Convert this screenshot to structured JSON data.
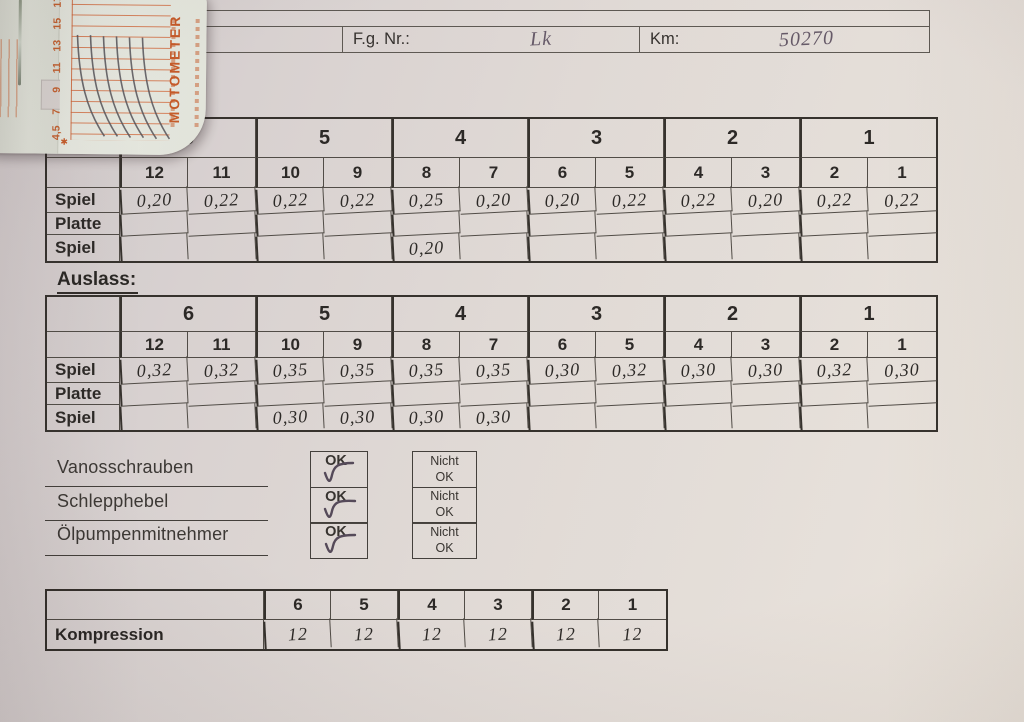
{
  "header": {
    "fg_label": "F.g. Nr.:",
    "fg_value": "Lk",
    "km_label": "Km:",
    "km_value": "50270"
  },
  "tool_card": {
    "brand": "MOTOMETER",
    "scale_labels": [
      "17",
      "15",
      "13",
      "11",
      "9",
      "7",
      "4,5"
    ]
  },
  "valve_tables": [
    {
      "title": "",
      "groups": [
        "6",
        "5",
        "4",
        "3",
        "2",
        "1"
      ],
      "valves": [
        "12",
        "11",
        "10",
        "9",
        "8",
        "7",
        "6",
        "5",
        "4",
        "3",
        "2",
        "1"
      ],
      "rows": [
        {
          "label": "Spiel",
          "values": [
            "0,20",
            "0,22",
            "0,22",
            "0,22",
            "0,25",
            "0,20",
            "0,20",
            "0,22",
            "0,22",
            "0,20",
            "0,22",
            "0,22"
          ]
        },
        {
          "label": "Platte",
          "values": [
            "",
            "",
            "",
            "",
            "",
            "",
            "",
            "",
            "",
            "",
            "",
            ""
          ]
        },
        {
          "label": "Spiel",
          "values": [
            "",
            "",
            "",
            "",
            "0,20",
            "",
            "",
            "",
            "",
            "",
            "",
            ""
          ]
        }
      ]
    },
    {
      "title": "Auslass:",
      "groups": [
        "6",
        "5",
        "4",
        "3",
        "2",
        "1"
      ],
      "valves": [
        "12",
        "11",
        "10",
        "9",
        "8",
        "7",
        "6",
        "5",
        "4",
        "3",
        "2",
        "1"
      ],
      "rows": [
        {
          "label": "Spiel",
          "values": [
            "0,32",
            "0,32",
            "0,35",
            "0,35",
            "0,35",
            "0,35",
            "0,30",
            "0,32",
            "0,30",
            "0,30",
            "0,32",
            "0,30"
          ]
        },
        {
          "label": "Platte",
          "values": [
            "",
            "",
            "",
            "",
            "",
            "",
            "",
            "",
            "",
            "",
            "",
            ""
          ]
        },
        {
          "label": "Spiel",
          "values": [
            "",
            "",
            "0,30",
            "0,30",
            "0,30",
            "0,30",
            "",
            "",
            "",
            "",
            "",
            ""
          ]
        }
      ]
    }
  ],
  "checks": {
    "ok_label": "OK",
    "nicht_label": [
      "Nicht",
      "OK"
    ],
    "items": [
      {
        "label": "Vanosschrauben",
        "ok_checked": true
      },
      {
        "label": "Schlepphebel",
        "ok_checked": true
      },
      {
        "label": "Ölpumpenmitnehmer",
        "ok_checked": true
      }
    ]
  },
  "kompression": {
    "label": "Kompression",
    "cylinders": [
      "6",
      "5",
      "4",
      "3",
      "2",
      "1"
    ],
    "values": [
      "12",
      "12",
      "12",
      "12",
      "12",
      "12"
    ]
  }
}
